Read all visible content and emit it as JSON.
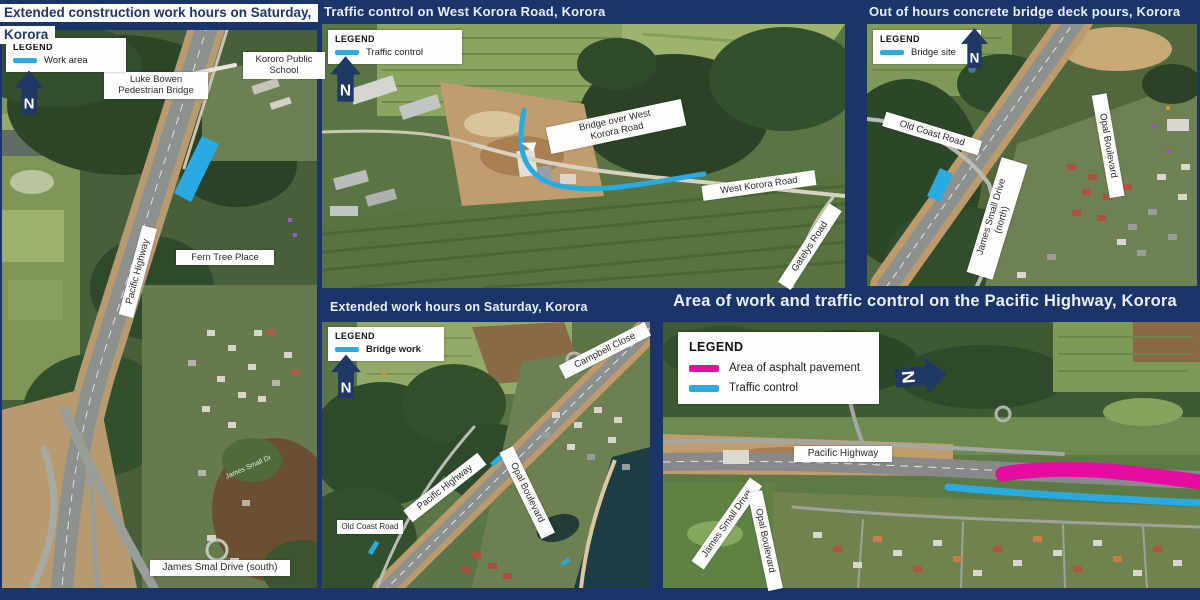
{
  "compass": {
    "label": "N"
  },
  "colors": {
    "background": "#1B356B",
    "accent_blue": "#29ABE2",
    "accent_magenta": "#E50CA0",
    "compass_navy": "#1F3864"
  },
  "panels": [
    {
      "id": "extended-construction-hours",
      "title_line1": "Extended construction work hours on Saturday,",
      "title_line2": "Korora",
      "legend": {
        "title": "LEGEND",
        "items": [
          {
            "label": "Work area",
            "color": "#29ABE2"
          }
        ]
      },
      "labels": {
        "luke_bowen": "Luke Bowen\nPedestrian Bridge",
        "kororo_school": "Kororo Public\nSchool",
        "pacific_highway": "Pacific Highway",
        "fern_tree": "Fern Tree Place",
        "james_smal_south": "James Smal Drive (south)",
        "poi_road": "James Small Dr"
      }
    },
    {
      "id": "traffic-control-west-korora",
      "title": "Traffic control on West Korora Road, Korora",
      "legend": {
        "title": "LEGEND",
        "items": [
          {
            "label": "Traffic control",
            "color": "#29ABE2"
          }
        ]
      },
      "labels": {
        "bridge_over": "Bridge over West\nKorora Road",
        "west_korora_road": "West Korora Road",
        "gatelys_road": "Gatelys Road"
      }
    },
    {
      "id": "bridge-deck-pours",
      "title": "Out of hours concrete bridge deck pours, Korora",
      "legend": {
        "title": "LEGEND",
        "items": [
          {
            "label": "Bridge site",
            "color": "#29ABE2"
          }
        ]
      },
      "labels": {
        "old_coast_road": "Old Coast Road",
        "james_small_north": "James Small Drive\n(north)",
        "opal_boulevard": "Opal Boulevard"
      }
    },
    {
      "id": "extended-work-hours",
      "title": "Extended work hours on Saturday, Korora",
      "legend": {
        "title": "LEGEND",
        "items": [
          {
            "label": "Bridge work",
            "color": "#29ABE2"
          }
        ]
      },
      "labels": {
        "campbell_close": "Campbell Close",
        "pacific_highway": "Pacific Highway",
        "opal_boulevard": "Opal Boulevard",
        "old_coast_road": "Old Coast Road"
      }
    },
    {
      "id": "area-of-work-pacific-highway",
      "title": "Area of work and traffic control on the Pacific Highway, Korora",
      "legend": {
        "title": "LEGEND",
        "items": [
          {
            "label": "Area of asphalt pavement",
            "color": "#E50CA0"
          },
          {
            "label": "Traffic control",
            "color": "#29ABE2"
          }
        ]
      },
      "labels": {
        "pacific_highway": "Pacific Highway",
        "james_small_drive": "James Small Drive",
        "opal_boulevard": "Opal Boulevard"
      }
    }
  ]
}
